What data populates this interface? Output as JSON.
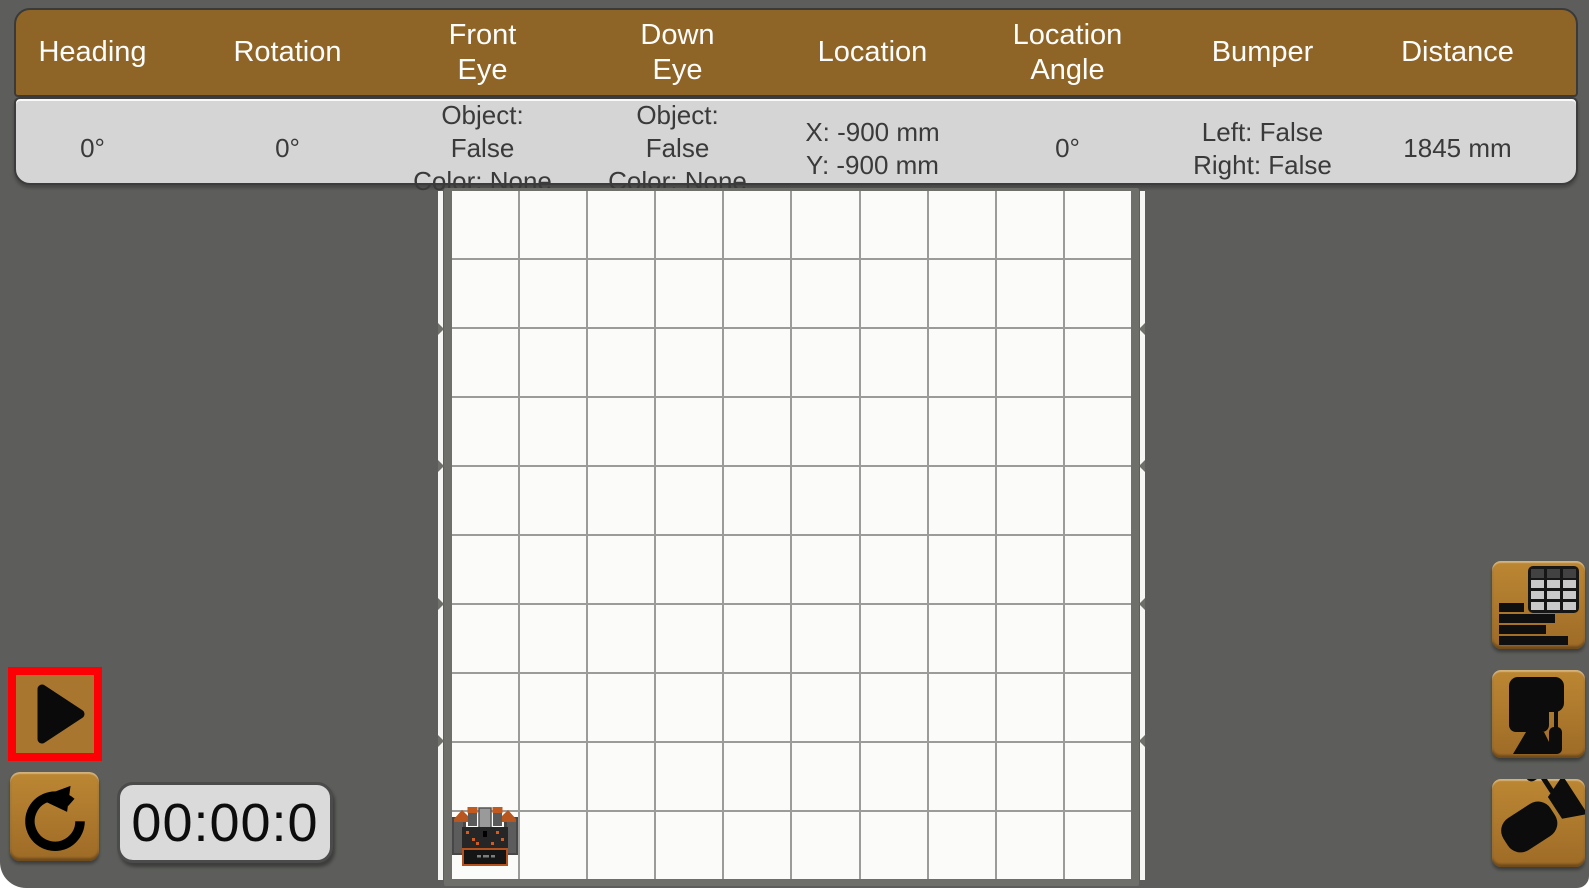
{
  "sensor_dashboard": {
    "columns": [
      {
        "id": "heading",
        "label": [
          "Heading"
        ],
        "value": [
          "0°"
        ]
      },
      {
        "id": "rotation",
        "label": [
          "Rotation"
        ],
        "value": [
          "0°"
        ]
      },
      {
        "id": "front-eye",
        "label": [
          "Front",
          "Eye"
        ],
        "value": [
          "Object: False",
          "Color: None"
        ]
      },
      {
        "id": "down-eye",
        "label": [
          "Down",
          "Eye"
        ],
        "value": [
          "Object: False",
          "Color: None"
        ]
      },
      {
        "id": "location",
        "label": [
          "Location"
        ],
        "value": [
          "X: -900 mm",
          "Y: -900 mm"
        ]
      },
      {
        "id": "location-angle",
        "label": [
          "Location",
          "Angle"
        ],
        "value": [
          "0°"
        ]
      },
      {
        "id": "bumper",
        "label": [
          "Bumper"
        ],
        "value": [
          "Left: False",
          "Right: False"
        ]
      },
      {
        "id": "distance",
        "label": [
          "Distance"
        ],
        "value": [
          "1845 mm"
        ]
      }
    ]
  },
  "timer": {
    "value": "00:00:0"
  },
  "playback": {
    "play_icon": "play-icon",
    "reset_icon": "reset-counterclockwise-icon",
    "play_highlighted": true
  },
  "toolbar": {
    "buttons": [
      {
        "icon": "sensor-dashboard-icon"
      },
      {
        "icon": "robot-monitor-icon"
      },
      {
        "icon": "camera-view-icon"
      }
    ]
  },
  "field": {
    "rows": 10,
    "cols": 10,
    "notch_rows": [
      2,
      4,
      6,
      8
    ],
    "robot_cell": {
      "col": 0,
      "row": 9
    }
  },
  "colors": {
    "header_brown": "#8f6527",
    "button_orange": "#b07d30",
    "highlight_red": "#fb0005",
    "panel_gray": "#5d5e5b",
    "value_row_gray": "#d5d5d6",
    "cell_white": "#fbfbfa",
    "grid_line_gray": "#9b9b99"
  }
}
